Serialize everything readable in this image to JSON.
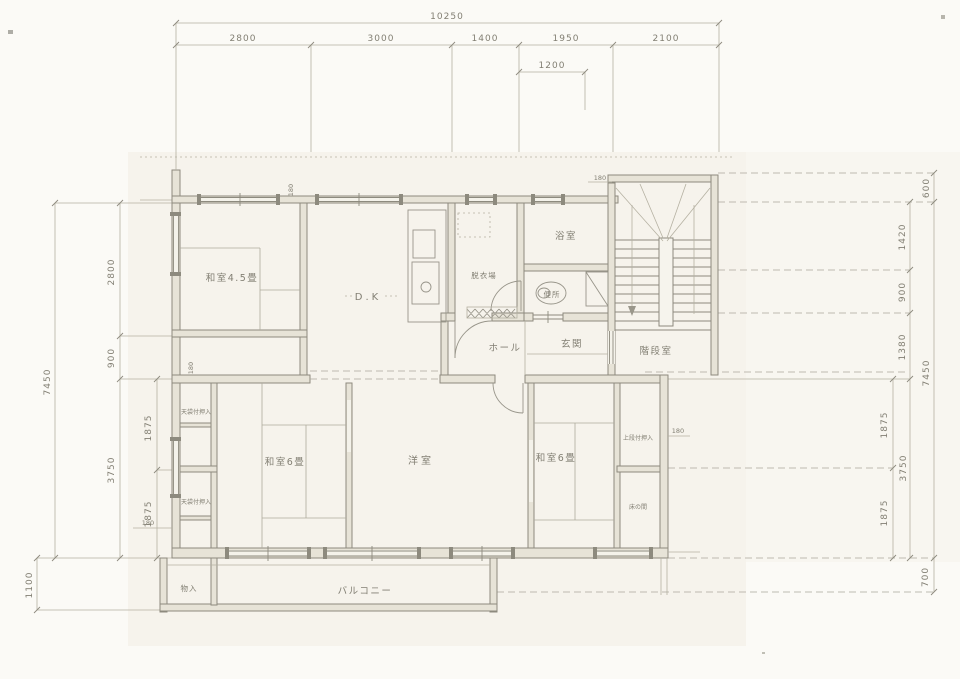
{
  "dims": {
    "top": {
      "total": "10250",
      "segs": [
        "2800",
        "3000",
        "1400",
        "1950",
        "2100"
      ],
      "sub": "1200"
    },
    "left": {
      "total": "7450",
      "segs": [
        "2800",
        "900",
        "3750"
      ],
      "halves": [
        "1875",
        "1875"
      ],
      "balcony": "1100"
    },
    "right": {
      "top": "600",
      "segs": [
        "1420",
        "900",
        "1380"
      ],
      "total": "7450",
      "halves": [
        "1875",
        "3750",
        "1875"
      ],
      "balcony": "700"
    },
    "wall_thickness": "180"
  },
  "rooms": {
    "washitsu45": "和室4.5畳",
    "dk": "D.K",
    "datsuiba": "脱衣場",
    "bath": "浴室",
    "toilet": "便所",
    "hall": "ホール",
    "genkan": "玄関",
    "stairwell": "階段室",
    "closet_left_top": "天袋付押入",
    "closet_left_bottom": "天袋付押入",
    "washitsu6_left": "和室6畳",
    "western_room": "洋室",
    "washitsu6_right": "和室6畳",
    "closet_jodan": "上段付押入",
    "tokonoma": "床の間",
    "storage": "物入",
    "balcony": "バルコニー"
  }
}
